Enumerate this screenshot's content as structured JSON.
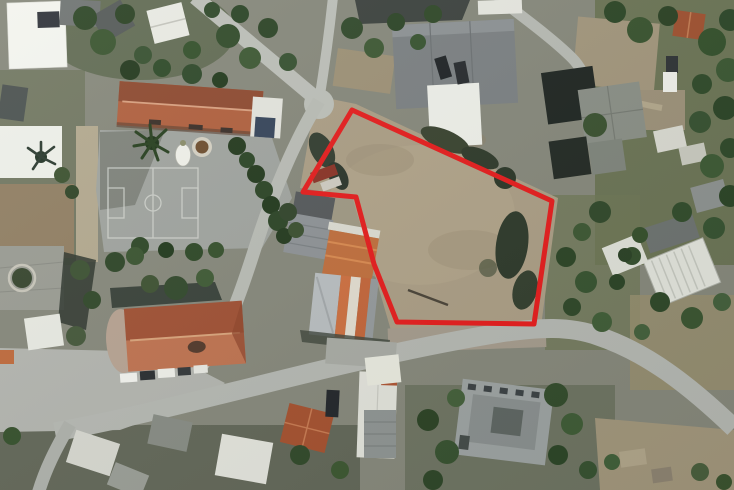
{
  "image": {
    "kind": "satellite-aerial-photo",
    "width_px": 734,
    "height_px": 490
  },
  "boundary_annotation": {
    "shape": "polygon",
    "stroke_color": "#e51d1d",
    "stroke_width_px": 5,
    "points": "352,110 552,201 534,324 397,322 374,264 356,197 303,192"
  },
  "palette": {
    "ground_base": "#86887b",
    "dirt_plot": "#ab9e85",
    "road": "#babdb6",
    "plaza": "#b3b5af",
    "courtyard": "#a0a49f",
    "tile_roof": "#a85535",
    "white_roof": "#f2f3ee",
    "tree_dark": "#2c4426",
    "shadow": "#2e362e"
  }
}
